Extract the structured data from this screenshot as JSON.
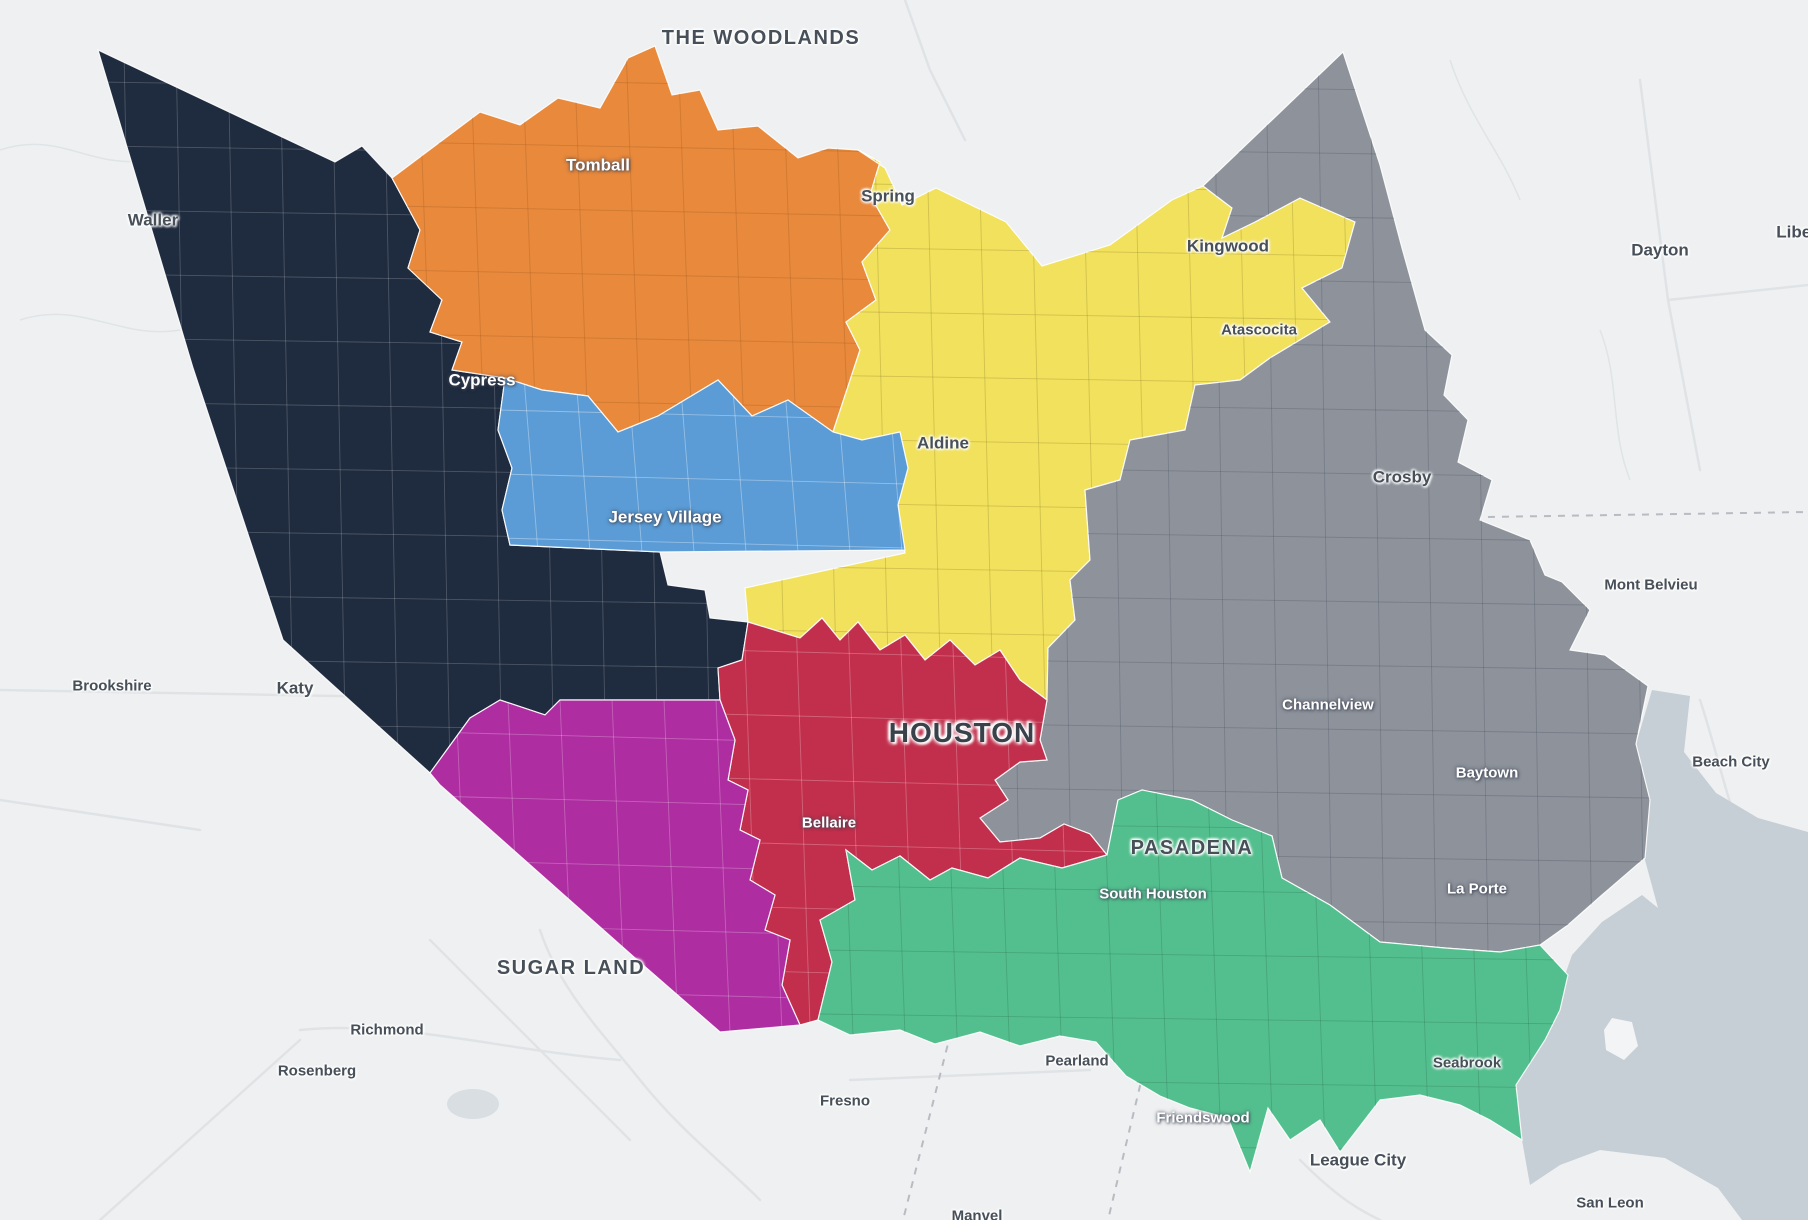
{
  "map": {
    "colors": {
      "land": "#EFF0F1",
      "water": "#C6CED6",
      "road": "#E0E3E6",
      "county_dash": "#B8BCC2",
      "label_dark": "#474F59",
      "label_light": "#FFFFFF"
    },
    "water_body": {
      "points": "1652,690 1690,696 1684,752 1716,793 1758,818 1808,832 1808,1220 1742,1220 1718,1188 1665,1158 1600,1150 1560,1165 1530,1185 1522,1140 1516,1085 1545,1040 1558,995 1572,955 1602,922 1642,895 1658,908 1645,860 1650,800 1636,744",
      "island_points": "1612,1018 1632,1022 1638,1046 1624,1060 1606,1050 1604,1030"
    },
    "districts": [
      {
        "id": "navy-west",
        "color": "#1F2B3E",
        "grid": "rgba(255,255,255,0.20)",
        "points": "98,50 335,162 362,146 392,178 420,230 408,268 442,300 430,332 462,342 452,370 505,378 498,430 512,468 502,510 510,545 660,552 668,585 705,590 710,618 748,622 742,660 718,668 720,700 560,700 545,715 500,700 470,718 430,773 283,640 193,368"
      },
      {
        "id": "navy-fragment",
        "color": "#1F2B3E",
        "grid": null,
        "points": "742,756 764,756 764,790 742,790"
      },
      {
        "id": "orange-northwest",
        "color": "#E8893C",
        "grid": "rgba(122,70,20,0.22)",
        "points": "392,178 480,112 520,125 558,98 600,108 628,58 655,46 672,95 700,90 718,130 758,126 798,158 828,148 858,150 880,162 870,195 890,230 862,262 876,300 846,322 860,350 833,432 788,400 752,416 718,380 658,416 618,432 588,396 542,390 505,378 452,370 462,342 430,332 442,300 408,268 420,230"
      },
      {
        "id": "yellow-north",
        "color": "#F1E15C",
        "grid": "rgba(135,120,40,0.30)",
        "points": "858,150 885,168 902,205 936,188 1006,222 1042,266 1110,245 1172,200 1203,186 1232,208 1222,238 1255,222 1300,198 1355,222 1342,268 1302,288 1330,322 1270,358 1240,380 1195,385 1185,430 1130,440 1120,480 1085,490 1090,560 1070,580 1075,620 1048,648 1047,700 1020,680 1000,650 975,665 950,640 925,660 905,635 880,650 858,622 840,640 822,618 800,638 748,622 745,588 905,553 898,505 908,468 900,432 862,440 833,432 860,350 846,322 876,300 862,262 890,230 870,195 880,162"
      },
      {
        "id": "gray-east",
        "color": "#8D929B",
        "grid": "rgba(70,76,86,0.28)",
        "points": "1343,52 1380,165 1402,248 1425,330 1452,355 1444,395 1468,420 1458,462 1492,480 1480,520 1530,540 1545,575 1562,582 1590,610 1570,650 1605,655 1648,686 1636,744 1650,800 1645,858 1602,895 1568,925 1540,945 1500,952 1445,948 1380,942 1330,905 1282,878 1272,836 1232,820 1192,800 1142,790 1118,800 1107,855 1090,834 1064,824 1040,838 1000,842 980,818 1008,800 995,780 1020,762 1047,760 1040,740 1047,700 1048,648 1075,620 1070,580 1090,560 1085,490 1120,480 1130,440 1185,430 1195,385 1240,380 1270,358 1330,322 1302,288 1342,268 1355,222 1300,198 1255,222 1222,238 1232,208 1203,186"
      },
      {
        "id": "blue-jersey-village",
        "color": "#5B9CD6",
        "grid": "rgba(255,255,255,0.35)",
        "points": "505,378 542,390 588,396 618,432 658,416 718,380 752,416 788,400 833,432 862,440 900,432 908,468 898,505 905,550 660,552 510,545 502,510 512,468 498,430"
      },
      {
        "id": "red-central",
        "color": "#C22F4C",
        "grid": "rgba(255,255,255,0.25)",
        "points": "748,622 800,638 822,618 840,640 858,622 880,650 905,635 925,660 950,640 975,665 1000,650 1020,680 1047,700 1040,740 1047,760 1020,762 995,780 1008,800 980,818 1000,842 1040,838 1064,824 1090,834 1107,855 1062,868 1020,858 988,878 952,868 930,880 900,856 872,870 846,850 855,900 820,920 832,962 818,1020 800,1025 782,985 790,940 765,930 775,895 750,880 760,840 740,830 748,790 728,780 735,740 720,700 718,668 742,660"
      },
      {
        "id": "purple-southwest",
        "color": "#AE2DA1",
        "grid": "rgba(255,255,255,0.25)",
        "points": "470,718 500,700 545,715 560,700 720,700 735,740 728,780 748,790 740,830 760,840 750,880 775,895 765,930 790,940 782,985 800,1025 720,1032 635,958 440,785 430,773"
      },
      {
        "id": "green-southeast",
        "color": "#53BF8E",
        "grid": "rgba(40,100,75,0.28)",
        "points": "846,850 872,870 900,856 930,880 952,868 988,878 1020,858 1062,868 1107,855 1118,800 1142,790 1192,800 1232,820 1272,836 1282,878 1330,905 1380,942 1445,948 1500,952 1540,945 1568,975 1560,1010 1545,1040 1516,1085 1522,1140 1490,1120 1460,1105 1420,1095 1380,1100 1357,1130 1340,1152 1320,1120 1290,1140 1268,1108 1250,1172 1228,1118 1190,1108 1160,1096 1126,1076 1096,1042 1060,1036 1020,1046 980,1032 935,1044 900,1030 850,1035 818,1020 832,962 820,920 855,900"
      }
    ],
    "labels": [
      {
        "text": "THE WOODLANDS",
        "x": 761,
        "y": 38,
        "tone": "dark",
        "size": "lg",
        "caps": true
      },
      {
        "text": "Waller",
        "x": 153,
        "y": 220,
        "tone": "dark",
        "size": "md"
      },
      {
        "text": "Tomball",
        "x": 598,
        "y": 165,
        "tone": "light",
        "size": "md"
      },
      {
        "text": "Spring",
        "x": 888,
        "y": 196,
        "tone": "dark",
        "size": "md"
      },
      {
        "text": "Kingwood",
        "x": 1228,
        "y": 246,
        "tone": "dark",
        "size": "md"
      },
      {
        "text": "Dayton",
        "x": 1660,
        "y": 250,
        "tone": "dark",
        "size": "md"
      },
      {
        "text": "Liber",
        "x": 1797,
        "y": 232,
        "tone": "dark",
        "size": "md"
      },
      {
        "text": "Atascocita",
        "x": 1259,
        "y": 330,
        "tone": "dark",
        "size": "sm"
      },
      {
        "text": "Cypress",
        "x": 482,
        "y": 380,
        "tone": "light",
        "size": "md"
      },
      {
        "text": "Aldine",
        "x": 943,
        "y": 443,
        "tone": "dark",
        "size": "md"
      },
      {
        "text": "Crosby",
        "x": 1402,
        "y": 477,
        "tone": "dark",
        "size": "md"
      },
      {
        "text": "Jersey Village",
        "x": 665,
        "y": 517,
        "tone": "light",
        "size": "md"
      },
      {
        "text": "Mont Belvieu",
        "x": 1651,
        "y": 585,
        "tone": "dark",
        "size": "sm"
      },
      {
        "text": "Brookshire",
        "x": 112,
        "y": 686,
        "tone": "dark",
        "size": "sm"
      },
      {
        "text": "Katy",
        "x": 295,
        "y": 688,
        "tone": "dark",
        "size": "md"
      },
      {
        "text": "HOUSTON",
        "x": 962,
        "y": 733,
        "tone": "dark",
        "size": "xl",
        "caps": true
      },
      {
        "text": "Channelview",
        "x": 1328,
        "y": 705,
        "tone": "light",
        "size": "sm"
      },
      {
        "text": "Baytown",
        "x": 1487,
        "y": 773,
        "tone": "light",
        "size": "sm"
      },
      {
        "text": "Beach City",
        "x": 1731,
        "y": 762,
        "tone": "dark",
        "size": "sm"
      },
      {
        "text": "Bellaire",
        "x": 829,
        "y": 823,
        "tone": "light",
        "size": "sm"
      },
      {
        "text": "PASADENA",
        "x": 1192,
        "y": 848,
        "tone": "dark",
        "size": "lg",
        "caps": true
      },
      {
        "text": "South Houston",
        "x": 1153,
        "y": 894,
        "tone": "light",
        "size": "sm"
      },
      {
        "text": "La Porte",
        "x": 1477,
        "y": 889,
        "tone": "light",
        "size": "sm"
      },
      {
        "text": "SUGAR LAND",
        "x": 571,
        "y": 968,
        "tone": "dark",
        "size": "lg",
        "caps": true
      },
      {
        "text": "Richmond",
        "x": 387,
        "y": 1030,
        "tone": "dark",
        "size": "sm"
      },
      {
        "text": "Rosenberg",
        "x": 317,
        "y": 1071,
        "tone": "dark",
        "size": "sm"
      },
      {
        "text": "Pearland",
        "x": 1077,
        "y": 1061,
        "tone": "dark",
        "size": "sm"
      },
      {
        "text": "Fresno",
        "x": 845,
        "y": 1101,
        "tone": "dark",
        "size": "sm"
      },
      {
        "text": "Friendswood",
        "x": 1203,
        "y": 1118,
        "tone": "light",
        "size": "sm"
      },
      {
        "text": "Seabrook",
        "x": 1467,
        "y": 1063,
        "tone": "dark",
        "size": "sm"
      },
      {
        "text": "League City",
        "x": 1358,
        "y": 1160,
        "tone": "dark",
        "size": "md"
      },
      {
        "text": "San Leon",
        "x": 1610,
        "y": 1203,
        "tone": "dark",
        "size": "sm"
      },
      {
        "text": "Manvel",
        "x": 977,
        "y": 1216,
        "tone": "dark",
        "size": "sm"
      }
    ]
  }
}
